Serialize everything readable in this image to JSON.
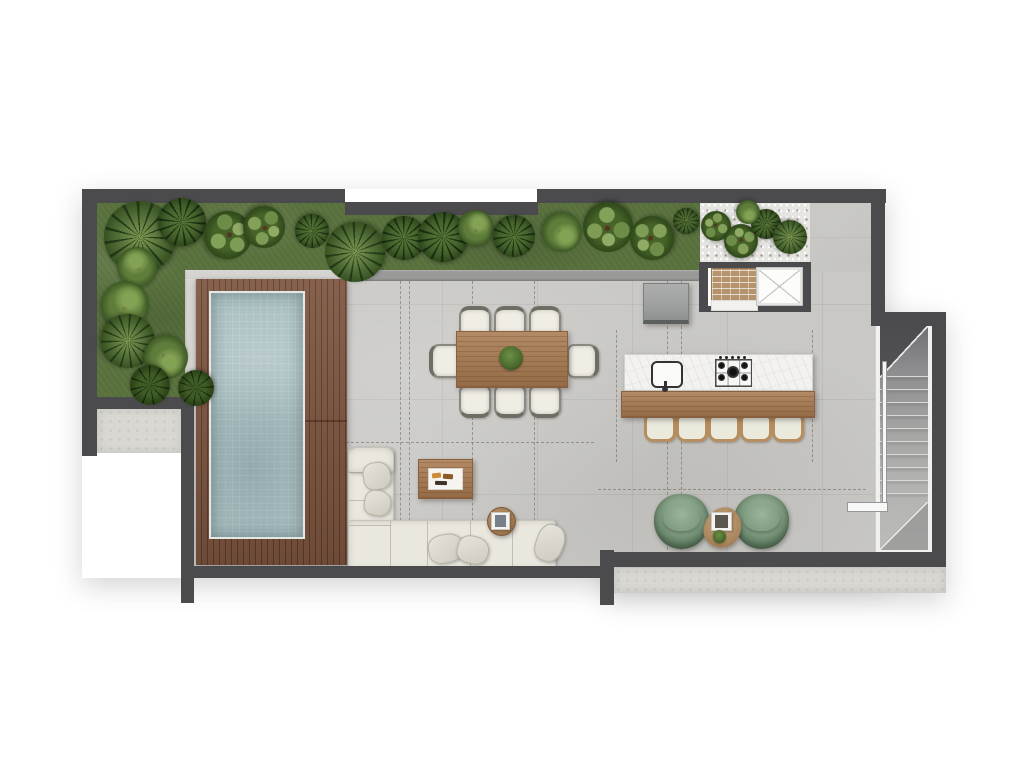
{
  "scene": {
    "type": "architectural-floor-plan",
    "view": "top-down-rendered",
    "visible_text": "none"
  },
  "colors": {
    "wall": "#4b4b4d",
    "floor": "#c9c8c5",
    "ledge": "#d8d7d1",
    "grass": "#5c7440",
    "gravel": "#e6e5e1",
    "curb": "#9a9a98",
    "curbLight": "#d5d4d0",
    "deck": "#7d553f",
    "pool": "#abc0c2",
    "sofa": "#eae7df",
    "wood": "#a97a51",
    "marble": "#f3f2ef",
    "chairGreen": "#8fa98f",
    "brick": "#b5946d"
  },
  "garden": {
    "plants": [
      {
        "x": 140,
        "y": 237,
        "r": 36,
        "kind": "palm"
      },
      {
        "x": 182,
        "y": 222,
        "r": 24,
        "kind": "fan"
      },
      {
        "x": 228,
        "y": 235,
        "r": 24,
        "kind": "leaf"
      },
      {
        "x": 264,
        "y": 227,
        "r": 21,
        "kind": "leaf"
      },
      {
        "x": 312,
        "y": 231,
        "r": 17,
        "kind": "fan"
      },
      {
        "x": 355,
        "y": 252,
        "r": 30,
        "kind": "palm"
      },
      {
        "x": 404,
        "y": 238,
        "r": 22,
        "kind": "fan"
      },
      {
        "x": 443,
        "y": 237,
        "r": 25,
        "kind": "fan"
      },
      {
        "x": 476,
        "y": 228,
        "r": 18,
        "kind": "bush"
      },
      {
        "x": 514,
        "y": 236,
        "r": 21,
        "kind": "fan"
      },
      {
        "x": 562,
        "y": 232,
        "r": 20,
        "kind": "bush"
      },
      {
        "x": 608,
        "y": 227,
        "r": 25,
        "kind": "leaf"
      },
      {
        "x": 652,
        "y": 238,
        "r": 22,
        "kind": "leaf"
      },
      {
        "x": 686,
        "y": 221,
        "r": 13,
        "kind": "fan"
      },
      {
        "x": 137,
        "y": 267,
        "r": 20,
        "kind": "bush"
      },
      {
        "x": 125,
        "y": 305,
        "r": 24,
        "kind": "bush"
      },
      {
        "x": 128,
        "y": 341,
        "r": 27,
        "kind": "palm"
      },
      {
        "x": 166,
        "y": 357,
        "r": 22,
        "kind": "bush"
      },
      {
        "x": 150,
        "y": 385,
        "r": 20,
        "kind": "fern"
      },
      {
        "x": 196,
        "y": 388,
        "r": 18,
        "kind": "fern"
      },
      {
        "x": 716,
        "y": 226,
        "r": 15,
        "kind": "leaf"
      },
      {
        "x": 741,
        "y": 241,
        "r": 17,
        "kind": "leaf"
      },
      {
        "x": 766,
        "y": 224,
        "r": 15,
        "kind": "fan"
      },
      {
        "x": 790,
        "y": 237,
        "r": 17,
        "kind": "palm"
      },
      {
        "x": 748,
        "y": 212,
        "r": 12,
        "kind": "bush"
      }
    ]
  },
  "guides": [
    {
      "o": "v",
      "x": 400,
      "y1": 281,
      "y2": 566
    },
    {
      "o": "v",
      "x": 409,
      "y1": 281,
      "y2": 566
    },
    {
      "o": "v",
      "x": 472,
      "y1": 281,
      "y2": 566
    },
    {
      "o": "v",
      "x": 534,
      "y1": 281,
      "y2": 566
    },
    {
      "o": "v",
      "x": 616,
      "y1": 330,
      "y2": 462
    },
    {
      "o": "v",
      "x": 667,
      "y1": 281,
      "y2": 550
    },
    {
      "o": "v",
      "x": 681,
      "y1": 281,
      "y2": 550
    },
    {
      "o": "v",
      "x": 812,
      "y1": 330,
      "y2": 462
    },
    {
      "o": "h",
      "y": 442,
      "x1": 196,
      "x2": 594
    },
    {
      "o": "h",
      "y": 489,
      "x1": 598,
      "x2": 866
    }
  ],
  "stairs": {
    "tread_count": 10,
    "x": 880,
    "y0": 376,
    "step": 13,
    "w": 48
  },
  "dining": {
    "chairs": [
      {
        "x": 459,
        "y": 306,
        "w": 28,
        "h": 26,
        "side": "top"
      },
      {
        "x": 494,
        "y": 306,
        "w": 28,
        "h": 26,
        "side": "top"
      },
      {
        "x": 529,
        "y": 306,
        "w": 28,
        "h": 26,
        "side": "top"
      },
      {
        "x": 459,
        "y": 385,
        "w": 28,
        "h": 27,
        "side": "bottom"
      },
      {
        "x": 494,
        "y": 385,
        "w": 28,
        "h": 27,
        "side": "bottom"
      },
      {
        "x": 529,
        "y": 385,
        "w": 28,
        "h": 27,
        "side": "bottom"
      },
      {
        "x": 429,
        "y": 344,
        "w": 28,
        "h": 30,
        "side": "left"
      },
      {
        "x": 567,
        "y": 344,
        "w": 26,
        "h": 30,
        "side": "right"
      }
    ]
  },
  "kitchen": {
    "stool_xs": [
      644,
      676,
      708,
      740,
      772
    ],
    "stool_y": 415,
    "stool_w": 26,
    "stool_h": 21
  }
}
